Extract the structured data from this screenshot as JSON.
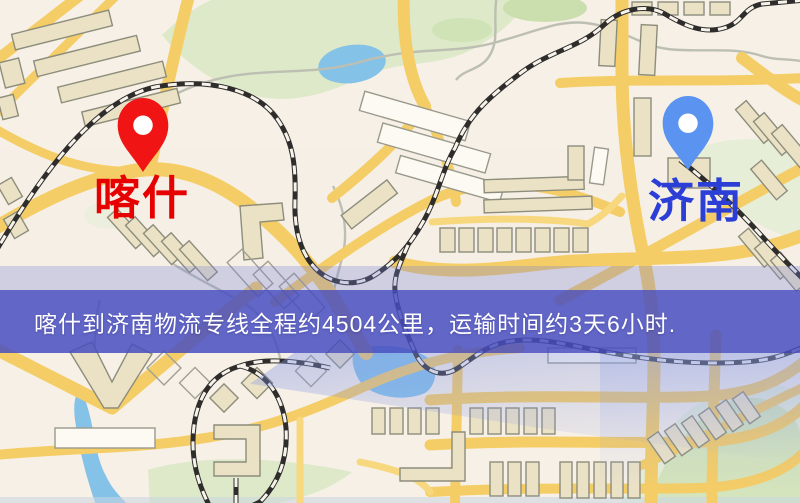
{
  "map": {
    "origin_label": "喀什",
    "destination_label": "济南",
    "origin_label_color": "#e60000",
    "destination_label_color": "#2b3fd6",
    "origin_pin_color": "#f01414",
    "destination_pin_color": "#5a93f0"
  },
  "banner": {
    "text": "喀什到济南物流专线全程约4504公里，运输时间约3天6小时.",
    "background_color": "#484ec0",
    "text_color": "#ffffff"
  }
}
